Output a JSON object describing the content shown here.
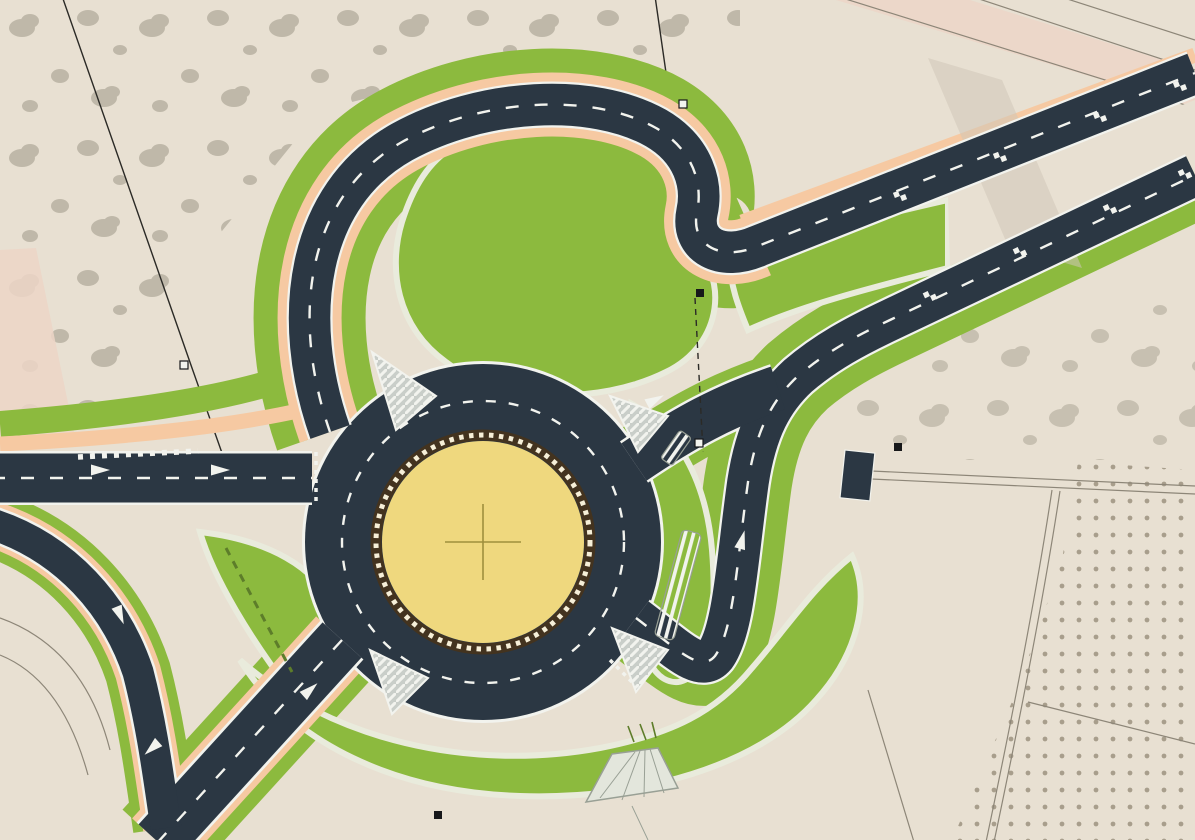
{
  "map": {
    "type": "engineering-site-plan",
    "subject": "two-lane roundabout with bypass loop and divided highway over aerial photo",
    "features": [
      "aerial-ground",
      "tree-scatter",
      "olive-grove",
      "cadastral-boundaries",
      "existing-road-parcel",
      "landscape-green",
      "sidewalk-peach-band",
      "roundabout-carriageway",
      "central-island-paver-circle",
      "center-cross-mark",
      "bypass-loop-road",
      "dual-carriageway-northeast",
      "west-approach-road",
      "southwest-leg",
      "slip-lane",
      "splitter-teardrop-island",
      "kidney-green-island",
      "gore-islands-hatched",
      "pavement-arrows",
      "lane-dash-markings",
      "chainage-checker-marks",
      "crosswalk-dash-row",
      "culvert-structure",
      "drainage-apron",
      "survey-markers",
      "field-tracks"
    ]
  },
  "colors": {
    "ground": "#e8e0d2",
    "tree": "#b2ab9b",
    "grove_dot": "#a89e8c",
    "asphalt": "#2b3743",
    "line": "#f2f3ee",
    "green": "#8cba3e",
    "green_dark_dash": "#5d7d2a",
    "curb": "#e9ebdc",
    "peach": "#f6c9a2",
    "parcel_pink": "#ecd5c7",
    "crossing_pave": "#cfc6b8",
    "island_yellow": "#efd87e",
    "island_ring": "#43331f",
    "island_pearl": "#f6efd8",
    "island_cross": "#9f8f3d",
    "gore_gray": "#c9cec9",
    "cadastral": "#8d8678",
    "boundary": "#2b2a26",
    "marker_dark": "#17181a",
    "structure": "#e3e6dc",
    "structure_line": "#99a095"
  }
}
